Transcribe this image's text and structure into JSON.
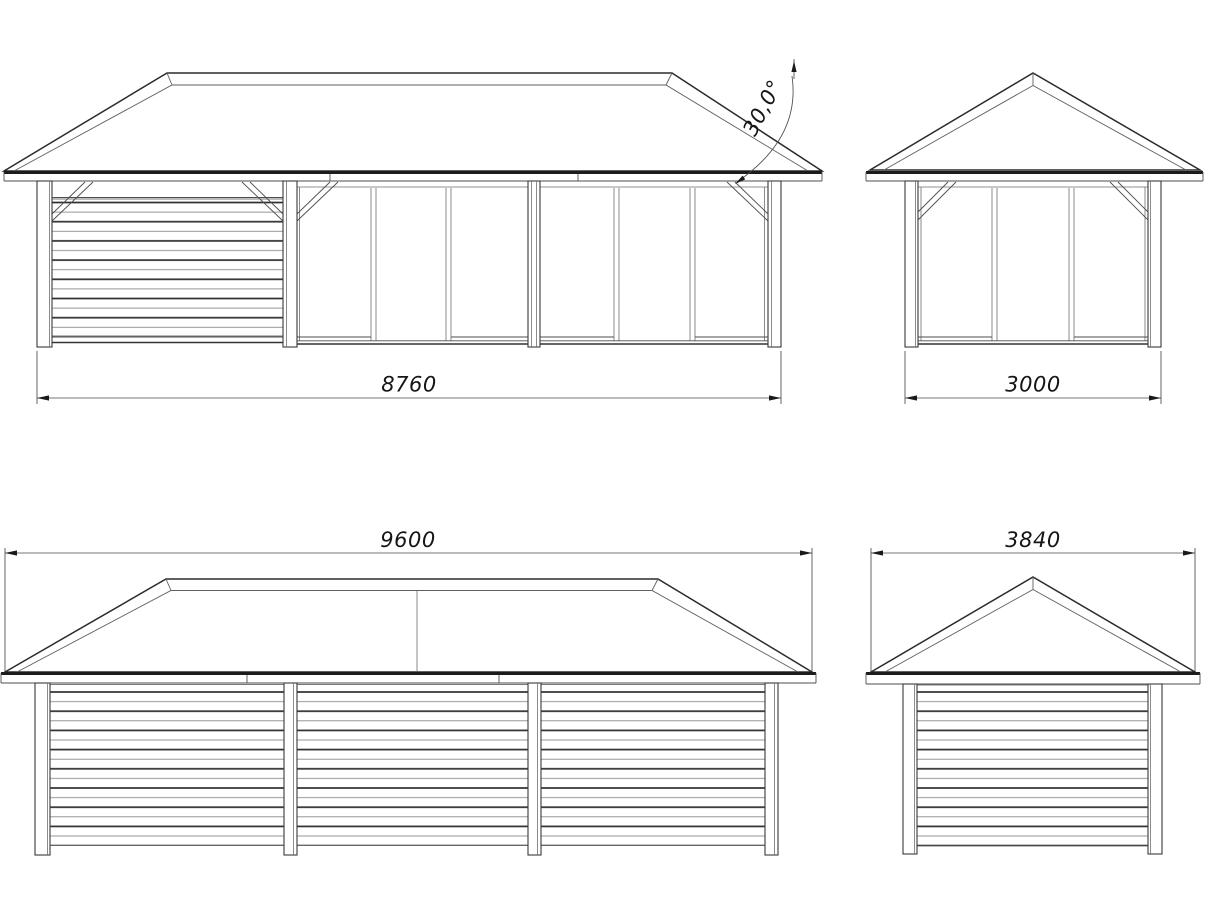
{
  "drawing": {
    "background_color": "#ffffff",
    "line_color": "#2b2b2b",
    "views": {
      "front": {
        "title": "front-elevation",
        "width_label": "8760",
        "roof_angle_label": "30,0°"
      },
      "side_glazed": {
        "title": "side-elevation-glazed",
        "width_label": "3000"
      },
      "rear": {
        "title": "rear-elevation",
        "width_label": "9600"
      },
      "side_clad": {
        "title": "side-elevation-clad",
        "width_label": "3840"
      }
    }
  }
}
